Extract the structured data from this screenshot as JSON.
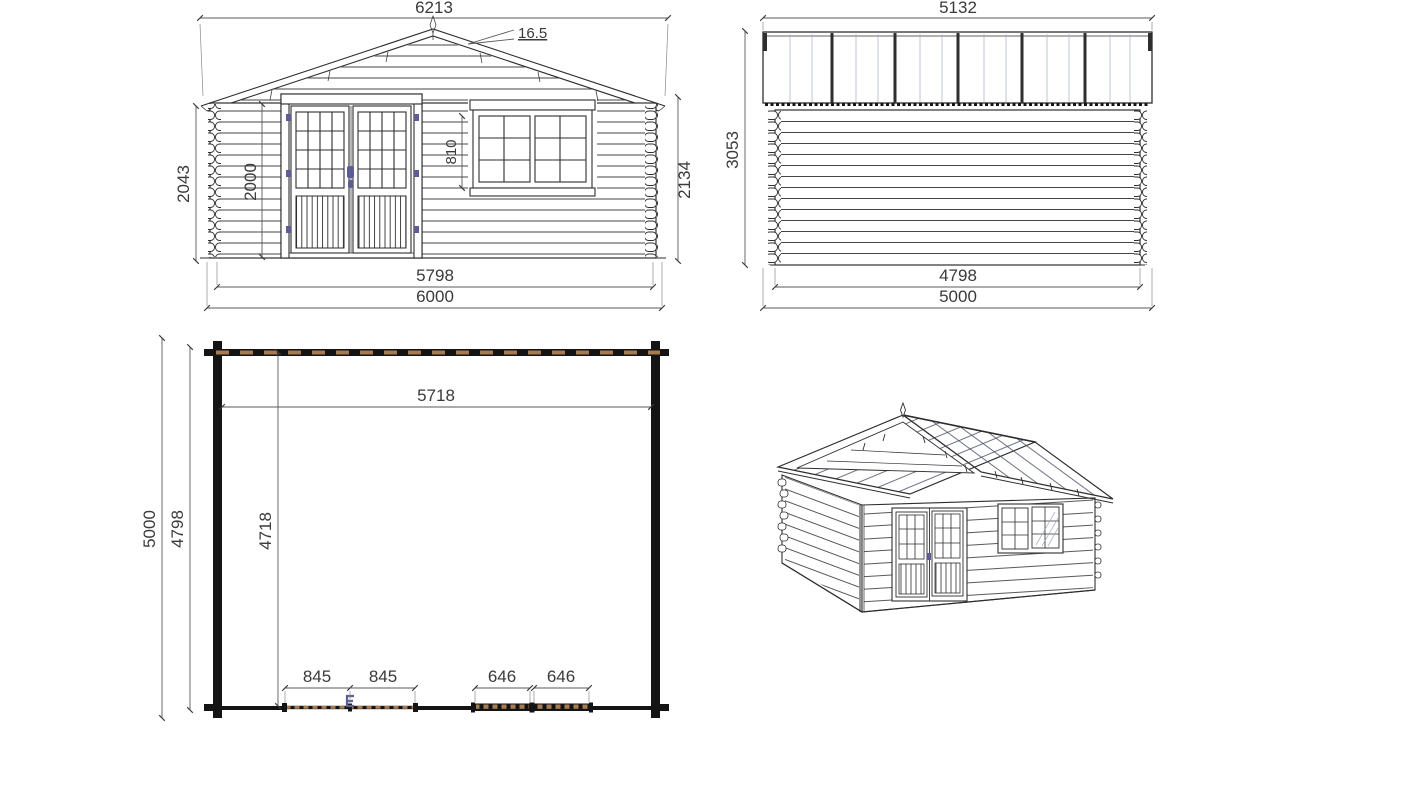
{
  "title": "Log cabin technical drawing",
  "colors": {
    "line": "#2e2e2e",
    "dimension": "#5a5a5a",
    "accent_blue": "#5d5d94",
    "wood_hatch": "#a87c52"
  },
  "front_view": {
    "roof_width": "6213",
    "roof_angle": "16.5",
    "wall_height_left": "2043",
    "door_height": "2000",
    "window_height": "810",
    "wall_height_right": "2134",
    "base_width": "5798",
    "overall_width": "6000"
  },
  "side_view": {
    "roof_width": "5132",
    "height": "3053",
    "base_width": "4798",
    "overall_width": "5000"
  },
  "floor_plan": {
    "inner_width": "5718",
    "outer_depth": "5000",
    "base_depth": "4798",
    "inner_depth": "4718",
    "door_leaf_left": "845",
    "door_leaf_right": "845",
    "window_left": "646",
    "window_right": "646"
  }
}
